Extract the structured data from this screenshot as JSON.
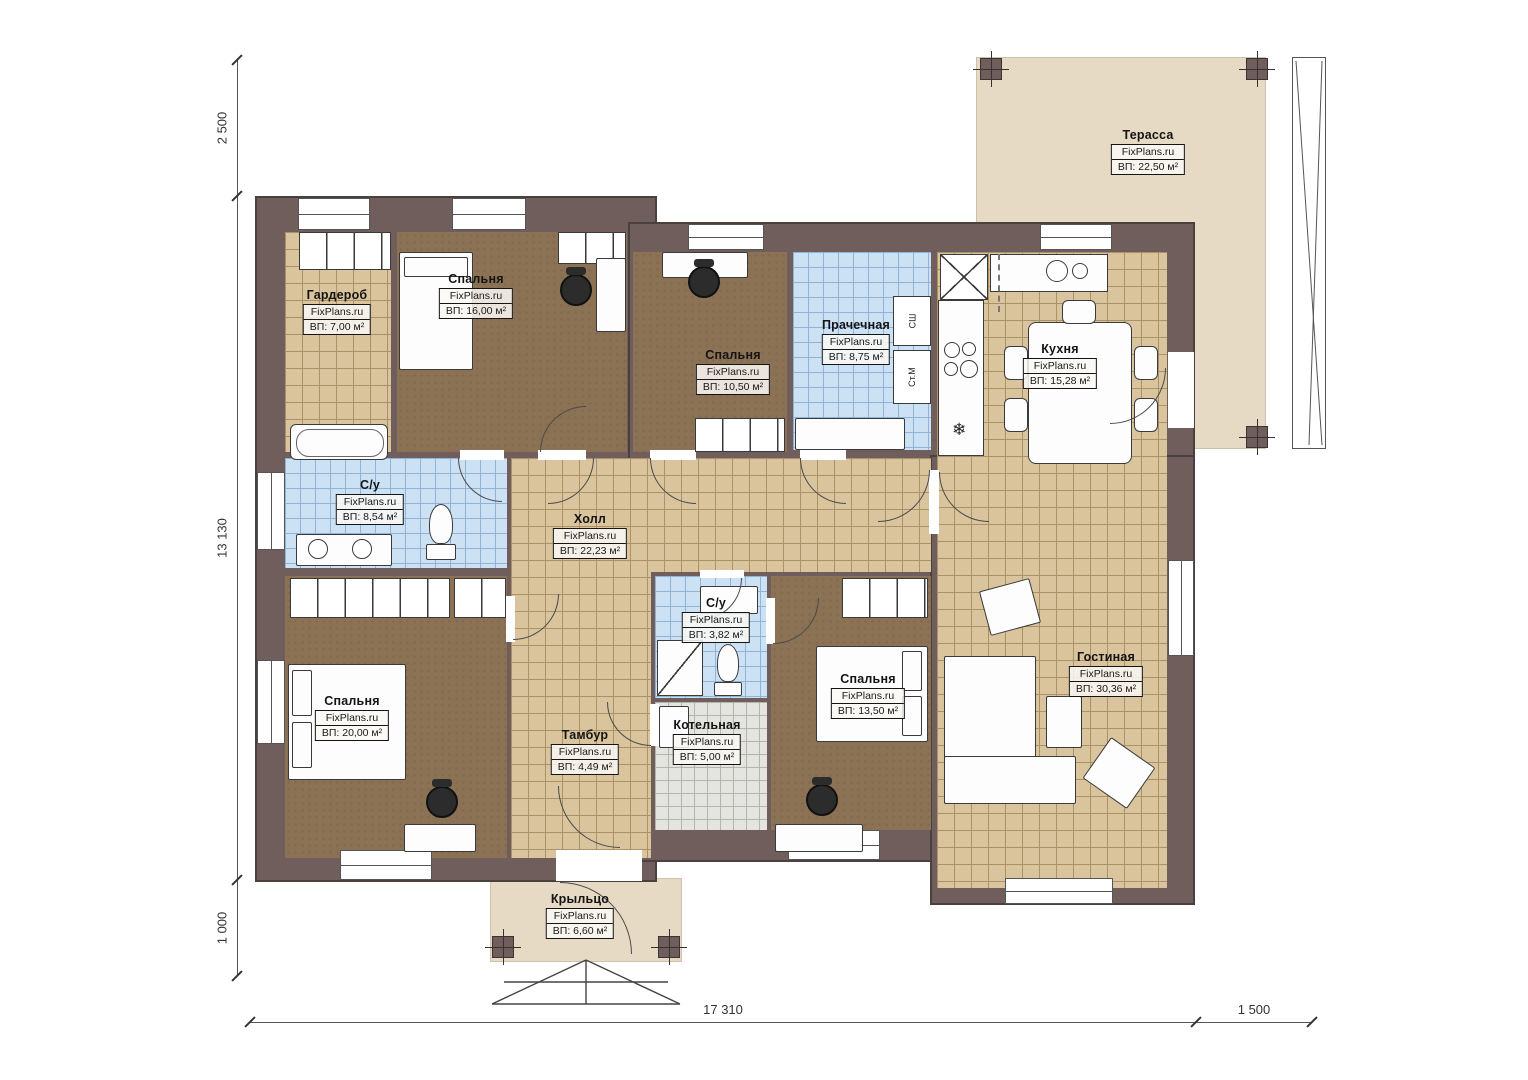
{
  "brand": "FixPlans.ru",
  "rooms": {
    "terrace": {
      "name": "Терасса",
      "area": "ВП: 22,50 м²"
    },
    "garderob": {
      "name": "Гардероб",
      "area": "ВП: 7,00 м²"
    },
    "bedroom16": {
      "name": "Спальня",
      "area": "ВП: 16,00 м²"
    },
    "bedroom105": {
      "name": "Спальня",
      "area": "ВП: 10,50 м²"
    },
    "laundry": {
      "name": "Прачечная",
      "area": "ВП: 8,75 м²"
    },
    "kitchen": {
      "name": "Кухня",
      "area": "ВП: 15,28 м²"
    },
    "bath_main": {
      "name": "С/у",
      "area": "ВП: 8,54 м²"
    },
    "hall": {
      "name": "Холл",
      "area": "ВП: 22,23 м²"
    },
    "bath_small": {
      "name": "С/у",
      "area": "ВП: 3,82 м²"
    },
    "bedroom20": {
      "name": "Спальня",
      "area": "ВП: 20,00 м²"
    },
    "tambur": {
      "name": "Тамбур",
      "area": "ВП: 4,49 м²"
    },
    "boiler": {
      "name": "Котельная",
      "area": "ВП: 5,00 м²"
    },
    "bedroom135": {
      "name": "Спальня",
      "area": "ВП: 13,50 м²"
    },
    "living": {
      "name": "Гостиная",
      "area": "ВП: 30,36 м²"
    },
    "porch": {
      "name": "Крыльцо",
      "area": "ВП: 6,60 м²"
    }
  },
  "appliances": {
    "dryer": "СШ",
    "washer": "Ст.М"
  },
  "dimensions": {
    "top_left_v": "2 500",
    "left_v": "13 130",
    "bottom_left_v": "1 000",
    "bottom_main": "17 310",
    "bottom_right": "1 500"
  },
  "colors": {
    "wall": "#6f5e5b",
    "tile_tan": "#d9c49d",
    "tile_blue": "#cde1f5",
    "tile_gray": "#e4e4e1",
    "wood": "#8b7254",
    "outdoor": "#e7dac5"
  }
}
